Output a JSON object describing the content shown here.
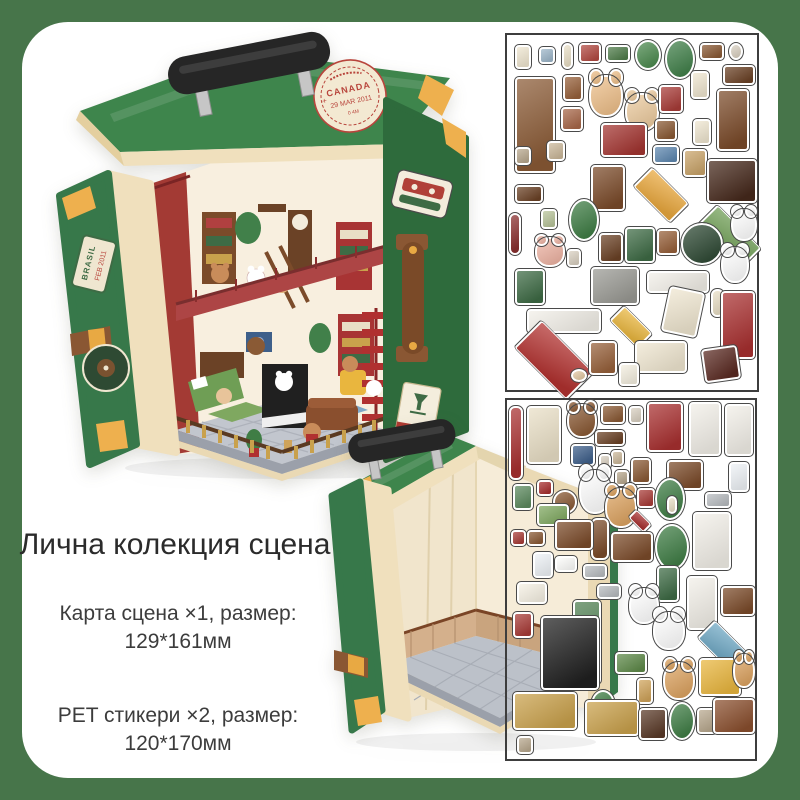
{
  "page": {
    "background": "#47754a",
    "card_color": "#ffffff"
  },
  "heading": "Лична колекция сцена",
  "specs": [
    {
      "line1": "Карта сцена ×1, размер:",
      "line2": "129*161мм"
    },
    {
      "line1": "PET стикери ×2, размер:",
      "line2": "120*170мм"
    }
  ],
  "decorated_suitcase": {
    "lid_stamp": {
      "country": "CANADA",
      "date": "29 MAR 2011",
      "code": "0 4M"
    },
    "flap_stamp": {
      "country": "BRASIL",
      "date": "FEB 2011"
    },
    "fragile_label": "FRAGILE",
    "shell_green": "#3e854c",
    "trim_cream": "#f0e0bd"
  },
  "sticker_sheets": [
    {
      "name": "sheet-1",
      "items": [
        {
          "n": "note-paper",
          "x": 8,
          "y": 10,
          "w": 16,
          "h": 24,
          "c": "#efe6d0"
        },
        {
          "n": "blue-frame",
          "x": 32,
          "y": 12,
          "w": 16,
          "h": 17,
          "c": "#9db6c9"
        },
        {
          "n": "candlestick",
          "x": 55,
          "y": 8,
          "w": 11,
          "h": 26,
          "c": "#e9dfc6",
          "s": "t"
        },
        {
          "n": "book-stack",
          "x": 72,
          "y": 8,
          "w": 22,
          "h": 20,
          "c": "#b24a42"
        },
        {
          "n": "green-box-books",
          "x": 99,
          "y": 10,
          "w": 24,
          "h": 17,
          "c": "#507d4b"
        },
        {
          "n": "hanging-plant",
          "x": 128,
          "y": 5,
          "w": 26,
          "h": 30,
          "c": "#4c8a4f",
          "s": "c"
        },
        {
          "n": "potted-plant-large",
          "x": 158,
          "y": 4,
          "w": 30,
          "h": 40,
          "c": "#41804a",
          "s": "c"
        },
        {
          "n": "brown-case",
          "x": 193,
          "y": 8,
          "w": 24,
          "h": 17,
          "c": "#8a5a35"
        },
        {
          "n": "round-frame",
          "x": 222,
          "y": 8,
          "w": 14,
          "h": 17,
          "c": "#d9d0c1",
          "s": "c"
        },
        {
          "n": "wall-shelf-dark",
          "x": 216,
          "y": 30,
          "w": 32,
          "h": 20,
          "c": "#6b4226"
        },
        {
          "n": "bookshelf-tall",
          "x": 8,
          "y": 42,
          "w": 40,
          "h": 96,
          "c": "#8a5a35"
        },
        {
          "n": "mini-bookshelf",
          "x": 56,
          "y": 40,
          "w": 20,
          "h": 26,
          "c": "#97613b"
        },
        {
          "n": "book-row",
          "x": 54,
          "y": 72,
          "w": 22,
          "h": 24,
          "c": "#a8684a"
        },
        {
          "n": "bear-lamp",
          "x": 82,
          "y": 40,
          "w": 34,
          "h": 42,
          "c": "#eec08b",
          "s": "a"
        },
        {
          "n": "bear-cocoa",
          "x": 118,
          "y": 58,
          "w": 34,
          "h": 38,
          "c": "#eccb9f",
          "s": "a"
        },
        {
          "n": "red-books",
          "x": 152,
          "y": 50,
          "w": 24,
          "h": 28,
          "c": "#a83c38"
        },
        {
          "n": "beige-tag",
          "x": 184,
          "y": 36,
          "w": 18,
          "h": 28,
          "c": "#efe6d0"
        },
        {
          "n": "grandfather-clock",
          "x": 210,
          "y": 54,
          "w": 32,
          "h": 62,
          "c": "#7b4b2a"
        },
        {
          "n": "small-books",
          "x": 148,
          "y": 84,
          "w": 22,
          "h": 22,
          "c": "#8a5a35"
        },
        {
          "n": "red-chest",
          "x": 94,
          "y": 88,
          "w": 46,
          "h": 34,
          "c": "#a33531"
        },
        {
          "n": "blue-box",
          "x": 146,
          "y": 110,
          "w": 26,
          "h": 19,
          "c": "#5f88b0"
        },
        {
          "n": "tag-paper",
          "x": 186,
          "y": 84,
          "w": 18,
          "h": 26,
          "c": "#efe6d0"
        },
        {
          "n": "bucket-books",
          "x": 176,
          "y": 114,
          "w": 24,
          "h": 28,
          "c": "#c9a46a"
        },
        {
          "n": "dresser-dark",
          "x": 200,
          "y": 124,
          "w": 50,
          "h": 44,
          "c": "#46291c"
        },
        {
          "n": "frame-pair",
          "x": 40,
          "y": 106,
          "w": 18,
          "h": 20,
          "c": "#cbb89a"
        },
        {
          "n": "mini-frame",
          "x": 8,
          "y": 112,
          "w": 16,
          "h": 18,
          "c": "#b8a88e"
        },
        {
          "n": "ladder",
          "x": 84,
          "y": 130,
          "w": 34,
          "h": 46,
          "c": "#7b4b2a"
        },
        {
          "n": "orange-rug",
          "x": 128,
          "y": 134,
          "w": 52,
          "h": 52,
          "c": "#e9a83e",
          "s": "i"
        },
        {
          "n": "green-rug-large",
          "x": 190,
          "y": 172,
          "w": 62,
          "h": 62,
          "c": "#6f9e55",
          "s": "i"
        },
        {
          "n": "wall-shelf-2",
          "x": 8,
          "y": 150,
          "w": 28,
          "h": 18,
          "c": "#6b4226"
        },
        {
          "n": "palm-plant",
          "x": 62,
          "y": 164,
          "w": 30,
          "h": 42,
          "c": "#3f7d45",
          "s": "c"
        },
        {
          "n": "red-baton",
          "x": 2,
          "y": 178,
          "w": 12,
          "h": 42,
          "c": "#8a2f2f",
          "s": "t"
        },
        {
          "n": "frame-green",
          "x": 34,
          "y": 174,
          "w": 16,
          "h": 20,
          "c": "#b8c49a"
        },
        {
          "n": "jar",
          "x": 60,
          "y": 214,
          "w": 14,
          "h": 18,
          "c": "#d9d0c1"
        },
        {
          "n": "bear-pink",
          "x": 28,
          "y": 202,
          "w": 30,
          "h": 30,
          "c": "#eeb4a4",
          "s": "a"
        },
        {
          "n": "gramophone",
          "x": 92,
          "y": 198,
          "w": 24,
          "h": 30,
          "c": "#6b4226"
        },
        {
          "n": "fireplace-green",
          "x": 118,
          "y": 192,
          "w": 30,
          "h": 36,
          "c": "#3e6b45"
        },
        {
          "n": "crate",
          "x": 150,
          "y": 194,
          "w": 22,
          "h": 26,
          "c": "#97613b"
        },
        {
          "n": "vinyl-record",
          "x": 174,
          "y": 188,
          "w": 42,
          "h": 42,
          "c": "#2f4a35",
          "s": "c"
        },
        {
          "n": "bunny-cup",
          "x": 224,
          "y": 174,
          "w": 26,
          "h": 32,
          "c": "#ffffff",
          "s": "a"
        },
        {
          "n": "bunny-book",
          "x": 214,
          "y": 212,
          "w": 28,
          "h": 36,
          "c": "#ffffff",
          "s": "a"
        },
        {
          "n": "green-armchair",
          "x": 8,
          "y": 234,
          "w": 30,
          "h": 36,
          "c": "#3e6b45"
        },
        {
          "n": "kitchen-counter",
          "x": 84,
          "y": 232,
          "w": 48,
          "h": 38,
          "c": "#9a9a94"
        },
        {
          "n": "railing-short",
          "x": 140,
          "y": 236,
          "w": 62,
          "h": 22,
          "c": "#f2efe8"
        },
        {
          "n": "candle-tall",
          "x": 204,
          "y": 254,
          "w": 13,
          "h": 28,
          "c": "#e9dfc6",
          "s": "t"
        },
        {
          "n": "railing-long",
          "x": 20,
          "y": 274,
          "w": 74,
          "h": 24,
          "c": "#f2efe8"
        },
        {
          "n": "red-floor-tile",
          "x": 10,
          "y": 288,
          "w": 74,
          "h": 74,
          "c": "#b23230",
          "s": "i"
        },
        {
          "n": "yellow-rug",
          "x": 104,
          "y": 272,
          "w": 40,
          "h": 40,
          "c": "#e9b63e",
          "s": "i"
        },
        {
          "n": "brasil-stamp-sticker",
          "x": 158,
          "y": 254,
          "w": 36,
          "h": 46,
          "c": "#efe6d0",
          "r": 12
        },
        {
          "n": "canada-stamp-sticker",
          "x": 128,
          "y": 306,
          "w": 52,
          "h": 32,
          "c": "#efe6d0"
        },
        {
          "n": "spiral-stairs-red",
          "x": 214,
          "y": 256,
          "w": 34,
          "h": 68,
          "c": "#a83030"
        },
        {
          "n": "radio-wedge",
          "x": 196,
          "y": 312,
          "w": 36,
          "h": 34,
          "c": "#5a2a22",
          "r": -8
        },
        {
          "n": "stool-cat",
          "x": 82,
          "y": 306,
          "w": 28,
          "h": 34,
          "c": "#97613b"
        },
        {
          "n": "fragile-label-sticker",
          "x": 112,
          "y": 328,
          "w": 20,
          "h": 23,
          "c": "#f4efe0"
        },
        {
          "n": "mouse-small",
          "x": 64,
          "y": 334,
          "w": 16,
          "h": 13,
          "c": "#e3c9a4",
          "s": "c"
        }
      ]
    },
    {
      "name": "sheet-2",
      "items": [
        {
          "n": "curtain-red",
          "x": 2,
          "y": 6,
          "w": 14,
          "h": 74,
          "c": "#a83030",
          "s": "t"
        },
        {
          "n": "arched-window",
          "x": 20,
          "y": 6,
          "w": 34,
          "h": 58,
          "c": "#e9dfc6"
        },
        {
          "n": "deer-head",
          "x": 60,
          "y": 4,
          "w": 30,
          "h": 34,
          "c": "#8a5a35",
          "s": "a"
        },
        {
          "n": "treasure-chest",
          "x": 94,
          "y": 4,
          "w": 24,
          "h": 20,
          "c": "#8a5a35"
        },
        {
          "n": "jar-small",
          "x": 122,
          "y": 6,
          "w": 14,
          "h": 18,
          "c": "#d9d0c1"
        },
        {
          "n": "red-cabinet",
          "x": 140,
          "y": 2,
          "w": 36,
          "h": 50,
          "c": "#a83030"
        },
        {
          "n": "clothes-rack",
          "x": 182,
          "y": 2,
          "w": 32,
          "h": 54,
          "c": "#f2efe8"
        },
        {
          "n": "door-frame",
          "x": 218,
          "y": 4,
          "w": 28,
          "h": 52,
          "c": "#f2efe8"
        },
        {
          "n": "wall-shelf-3",
          "x": 88,
          "y": 30,
          "w": 30,
          "h": 16,
          "c": "#6b4226"
        },
        {
          "n": "jar-2",
          "x": 104,
          "y": 50,
          "w": 13,
          "h": 16,
          "c": "#cbb89a"
        },
        {
          "n": "nightstand",
          "x": 160,
          "y": 60,
          "w": 36,
          "h": 30,
          "c": "#7b4b2a"
        },
        {
          "n": "butterfly-frame",
          "x": 64,
          "y": 44,
          "w": 24,
          "h": 22,
          "c": "#3e5f8a"
        },
        {
          "n": "mini-jar",
          "x": 92,
          "y": 54,
          "w": 12,
          "h": 15,
          "c": "#d9d0c1"
        },
        {
          "n": "tiny-frame-2",
          "x": 108,
          "y": 70,
          "w": 14,
          "h": 16,
          "c": "#b8a88e"
        },
        {
          "n": "bookshelf-mini",
          "x": 124,
          "y": 58,
          "w": 20,
          "h": 26,
          "c": "#8a5a35"
        },
        {
          "n": "vase-porcelain",
          "x": 222,
          "y": 62,
          "w": 20,
          "h": 30,
          "c": "#eef2f6"
        },
        {
          "n": "gray-box",
          "x": 198,
          "y": 92,
          "w": 26,
          "h": 16,
          "c": "#b8bcc0"
        },
        {
          "n": "gift-box",
          "x": 30,
          "y": 80,
          "w": 16,
          "h": 16,
          "c": "#a83030"
        },
        {
          "n": "frame-green-2",
          "x": 6,
          "y": 84,
          "w": 20,
          "h": 26,
          "c": "#5d8a5f"
        },
        {
          "n": "globe",
          "x": 46,
          "y": 90,
          "w": 24,
          "h": 24,
          "c": "#8a5a35",
          "s": "c"
        },
        {
          "n": "cat-violin",
          "x": 72,
          "y": 70,
          "w": 32,
          "h": 44,
          "c": "#ffffff",
          "s": "a"
        },
        {
          "n": "teddy-bear",
          "x": 98,
          "y": 88,
          "w": 32,
          "h": 40,
          "c": "#dca361",
          "s": "a"
        },
        {
          "n": "books-mini-2",
          "x": 130,
          "y": 88,
          "w": 18,
          "h": 20,
          "c": "#a83c38"
        },
        {
          "n": "rug-mini-red",
          "x": 122,
          "y": 110,
          "w": 22,
          "h": 22,
          "c": "#a83030",
          "s": "i"
        },
        {
          "n": "plant-ivy",
          "x": 148,
          "y": 78,
          "w": 30,
          "h": 42,
          "c": "#3f7d45",
          "s": "c"
        },
        {
          "n": "candle-2",
          "x": 160,
          "y": 96,
          "w": 10,
          "h": 18,
          "c": "#e9dfc6",
          "s": "t"
        },
        {
          "n": "mirror-stand",
          "x": 186,
          "y": 112,
          "w": 38,
          "h": 58,
          "c": "#f2efe8"
        },
        {
          "n": "bench-green",
          "x": 30,
          "y": 104,
          "w": 32,
          "h": 22,
          "c": "#7fa860"
        },
        {
          "n": "cello",
          "x": 84,
          "y": 118,
          "w": 18,
          "h": 42,
          "c": "#7b4b2a",
          "s": "t"
        },
        {
          "n": "dresser-2",
          "x": 48,
          "y": 120,
          "w": 38,
          "h": 30,
          "c": "#7b4b2a"
        },
        {
          "n": "display-cabinet",
          "x": 104,
          "y": 132,
          "w": 42,
          "h": 30,
          "c": "#7b4b2a"
        },
        {
          "n": "monstera",
          "x": 148,
          "y": 124,
          "w": 34,
          "h": 46,
          "c": "#3f7d45",
          "s": "c"
        },
        {
          "n": "red-book",
          "x": 4,
          "y": 130,
          "w": 15,
          "h": 16,
          "c": "#a83c38"
        },
        {
          "n": "books-3",
          "x": 20,
          "y": 130,
          "w": 18,
          "h": 16,
          "c": "#8a5a35"
        },
        {
          "n": "vase-2",
          "x": 26,
          "y": 152,
          "w": 20,
          "h": 26,
          "c": "#eef2f6"
        },
        {
          "n": "book-open",
          "x": 48,
          "y": 156,
          "w": 22,
          "h": 16,
          "c": "#fdfdfb"
        },
        {
          "n": "soap-dish",
          "x": 10,
          "y": 182,
          "w": 30,
          "h": 22,
          "c": "#f6f1e4"
        },
        {
          "n": "tray-gray-1",
          "x": 76,
          "y": 164,
          "w": 24,
          "h": 15,
          "c": "#b8bcc0"
        },
        {
          "n": "tray-gray-2",
          "x": 90,
          "y": 184,
          "w": 24,
          "h": 15,
          "c": "#b8bcc0"
        },
        {
          "n": "green-shelf-tall",
          "x": 66,
          "y": 200,
          "w": 28,
          "h": 84,
          "c": "#4c7d4f"
        },
        {
          "n": "piano-black",
          "x": 34,
          "y": 216,
          "w": 58,
          "h": 74,
          "c": "#202020"
        },
        {
          "n": "red-pot",
          "x": 6,
          "y": 212,
          "w": 20,
          "h": 26,
          "c": "#a83c38"
        },
        {
          "n": "stool-tall-green",
          "x": 150,
          "y": 166,
          "w": 22,
          "h": 36,
          "c": "#3e6b45"
        },
        {
          "n": "door-frame-2",
          "x": 180,
          "y": 176,
          "w": 30,
          "h": 54,
          "c": "#f2efe8"
        },
        {
          "n": "dresser-3",
          "x": 214,
          "y": 186,
          "w": 34,
          "h": 30,
          "c": "#7b4b2a"
        },
        {
          "n": "rug-blue",
          "x": 192,
          "y": 222,
          "w": 48,
          "h": 48,
          "c": "#6fa8c4",
          "s": "i"
        },
        {
          "n": "cat-white-1",
          "x": 122,
          "y": 188,
          "w": 30,
          "h": 36,
          "c": "#ffffff",
          "s": "a"
        },
        {
          "n": "cat-white-2",
          "x": 146,
          "y": 212,
          "w": 32,
          "h": 38,
          "c": "#ffffff",
          "s": "a"
        },
        {
          "n": "bench-green-2",
          "x": 108,
          "y": 252,
          "w": 32,
          "h": 22,
          "c": "#5f8a4a"
        },
        {
          "n": "hourglass",
          "x": 130,
          "y": 278,
          "w": 16,
          "h": 26,
          "c": "#cfa35a"
        },
        {
          "n": "bear-scarf",
          "x": 156,
          "y": 262,
          "w": 32,
          "h": 38,
          "c": "#dca361",
          "s": "a"
        },
        {
          "n": "armchair-yellow",
          "x": 192,
          "y": 258,
          "w": 42,
          "h": 38,
          "c": "#e9b63e"
        },
        {
          "n": "bear-leaf",
          "x": 226,
          "y": 254,
          "w": 22,
          "h": 34,
          "c": "#dca361",
          "s": "a"
        },
        {
          "n": "plant-4",
          "x": 84,
          "y": 290,
          "w": 24,
          "h": 30,
          "c": "#3f7d45",
          "s": "c"
        },
        {
          "n": "balustrade-1",
          "x": 6,
          "y": 292,
          "w": 64,
          "h": 38,
          "c": "#c9a14c"
        },
        {
          "n": "balustrade-2",
          "x": 78,
          "y": 300,
          "w": 54,
          "h": 36,
          "c": "#c9a14c"
        },
        {
          "n": "table-round",
          "x": 132,
          "y": 308,
          "w": 28,
          "h": 32,
          "c": "#5a3a28"
        },
        {
          "n": "plant-5",
          "x": 162,
          "y": 302,
          "w": 26,
          "h": 38,
          "c": "#3f7d45",
          "s": "c"
        },
        {
          "n": "frame-gold",
          "x": 190,
          "y": 308,
          "w": 20,
          "h": 26,
          "c": "#b8a88e"
        },
        {
          "n": "sofa-brown",
          "x": 206,
          "y": 298,
          "w": 42,
          "h": 36,
          "c": "#8a4f2e"
        },
        {
          "n": "frame-tiny-3",
          "x": 10,
          "y": 336,
          "w": 16,
          "h": 18,
          "c": "#b8a88e"
        }
      ]
    }
  ]
}
